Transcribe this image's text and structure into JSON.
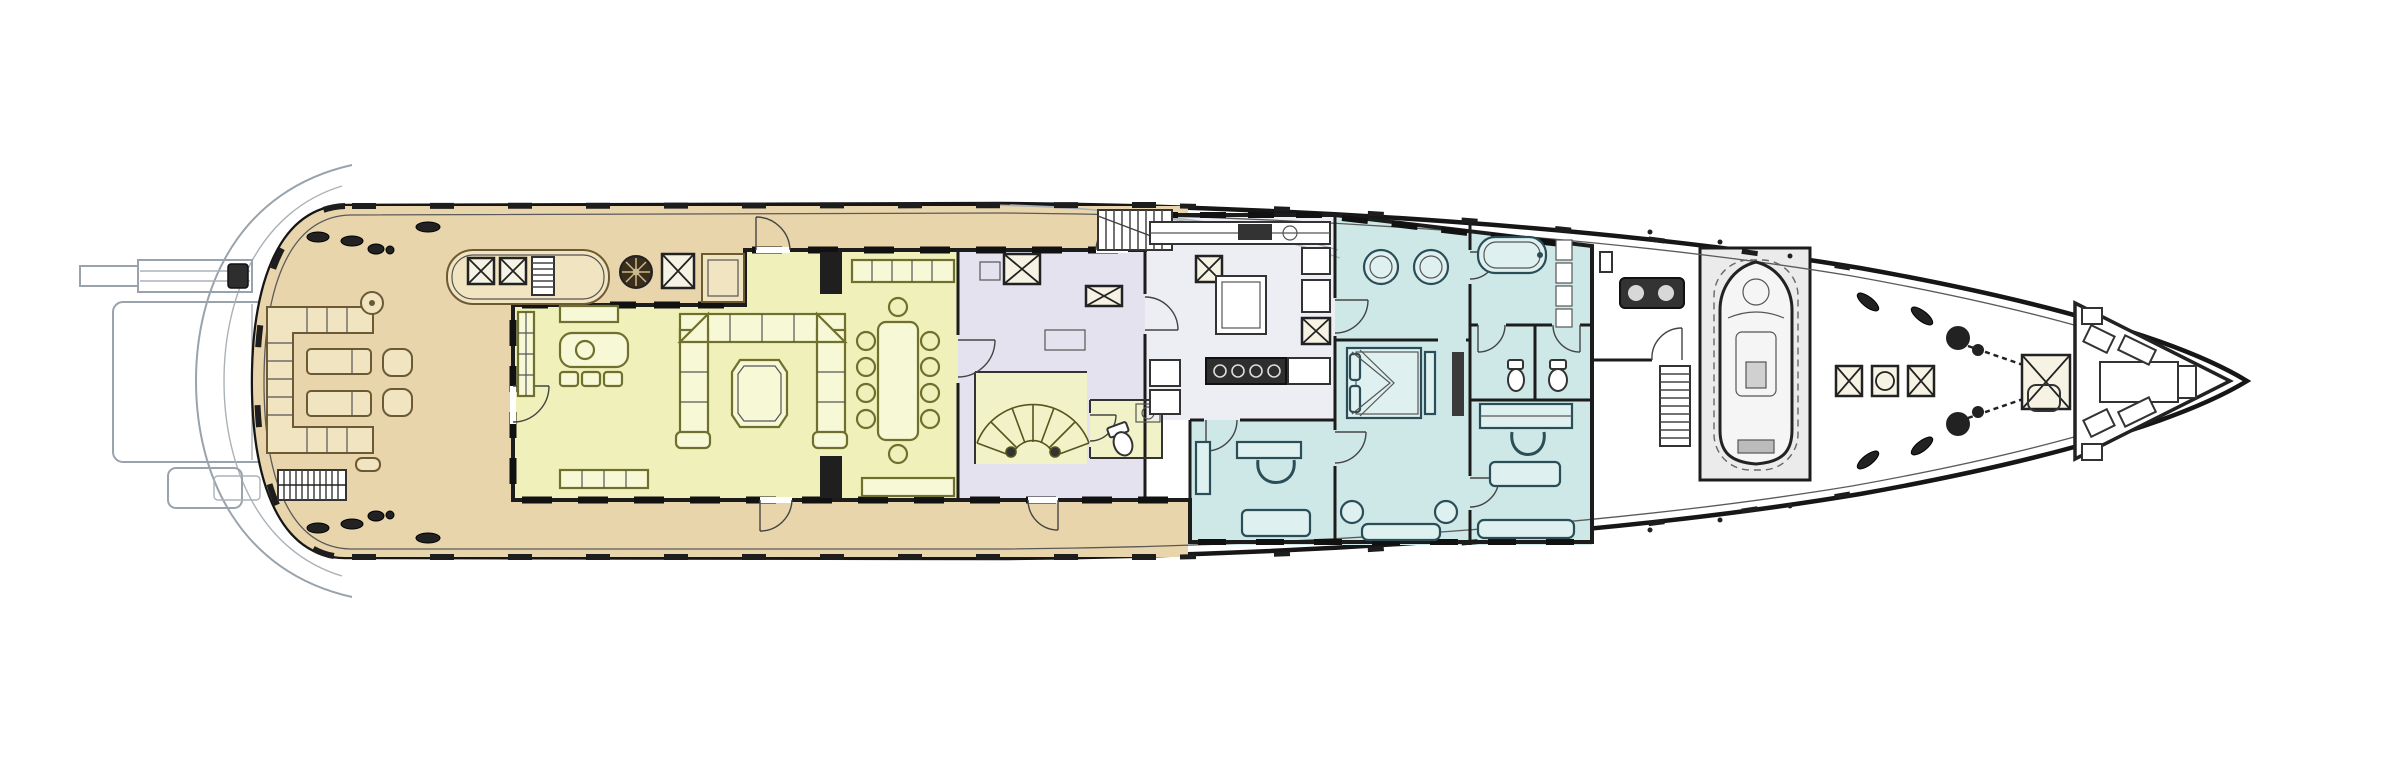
{
  "plan": {
    "name": "superyacht-main-deck-floor-plan",
    "view": "top-down",
    "orientation": "bow-right-stern-left",
    "canvas_background": "#ffffff"
  },
  "palette": {
    "hull_line": "#161616",
    "secondary_line": "#9aa3ab",
    "wall_line": "#1c1c1c",
    "teak_deck": "#e9d5ac",
    "salon_floor": "#f0f1ba",
    "stair_floor": "#f2f2c8",
    "lobby_floor": "#e4e2ef",
    "galley_floor": "#ededf4",
    "suite_floor": "#cde8e7",
    "garage_floor": "#ebebeb",
    "dark_fixture": "#2e2e2e"
  },
  "zones": [
    {
      "id": "swim-platform",
      "fill_ref": "white",
      "features": [
        "platform",
        "passerelle",
        "transom-arcs",
        "aft-step"
      ]
    },
    {
      "id": "aft-deck",
      "fill_ref": "teak_deck",
      "features": [
        "c-shaped-settee",
        "round-cocktail-tables",
        "sun-loungers",
        "armchairs",
        "stairs-to-swim-platform",
        "skylight-with-hatches",
        "companionway-ladder",
        "mushroom-vent",
        "deck-hatches",
        "mooring-cleats"
      ]
    },
    {
      "id": "main-salon",
      "fill_ref": "salon_floor",
      "features": [
        "octagonal-sectional-sofa",
        "octagonal-coffee-table",
        "loveseat",
        "ottomans",
        "tv-console",
        "sideboard"
      ]
    },
    {
      "id": "dining-room",
      "fill_ref": "salon_floor",
      "features": [
        "dining-table",
        "dining-chairs",
        "sideboards",
        "pillars"
      ]
    },
    {
      "id": "lobby",
      "fill_ref": "lobby_floor",
      "features": [
        "elevator",
        "dumbwaiter",
        "curved-staircase",
        "day-head",
        "side-deck-stair"
      ]
    },
    {
      "id": "galley",
      "fill_ref": "galley_floor",
      "features": [
        "island",
        "range-hob",
        "counters",
        "sink",
        "lockers"
      ]
    },
    {
      "id": "master-bathroom",
      "fill_ref": "suite_floor",
      "features": [
        "twin-round-basins",
        "bathtub",
        "wc-room-port",
        "wc-room-starboard",
        "linen-shelves"
      ]
    },
    {
      "id": "master-stateroom",
      "fill_ref": "suite_floor",
      "features": [
        "king-bed",
        "canopy-drapes",
        "footboard-bench",
        "tv-cabinet",
        "stools",
        "sofa"
      ]
    },
    {
      "id": "office",
      "fill_ref": "suite_floor",
      "features": [
        "desk",
        "u-chair",
        "coffee-table",
        "cabinet"
      ]
    },
    {
      "id": "study",
      "fill_ref": "suite_floor",
      "features": [
        "desk",
        "u-chair",
        "coffee-table",
        "sofa"
      ]
    },
    {
      "id": "foredeck",
      "fill_ref": "white",
      "features": [
        "crew-room",
        "machinery",
        "crew-stair",
        "tender-garage",
        "tender",
        "deck-hatch-row",
        "anchor-windlasses",
        "chain-hatch",
        "bow-seating",
        "angled-cleats"
      ]
    }
  ],
  "counts": {
    "dining_chairs": 10,
    "sun_loungers": 2,
    "aft_armchairs": 2,
    "salon_ottomans": 3,
    "bathroom_basins": 2,
    "wc_rooms": 2,
    "bow_hatch_row": 3,
    "anchor_windlasses": 2,
    "bow_angled_cleats": 4,
    "tenders": 1
  }
}
